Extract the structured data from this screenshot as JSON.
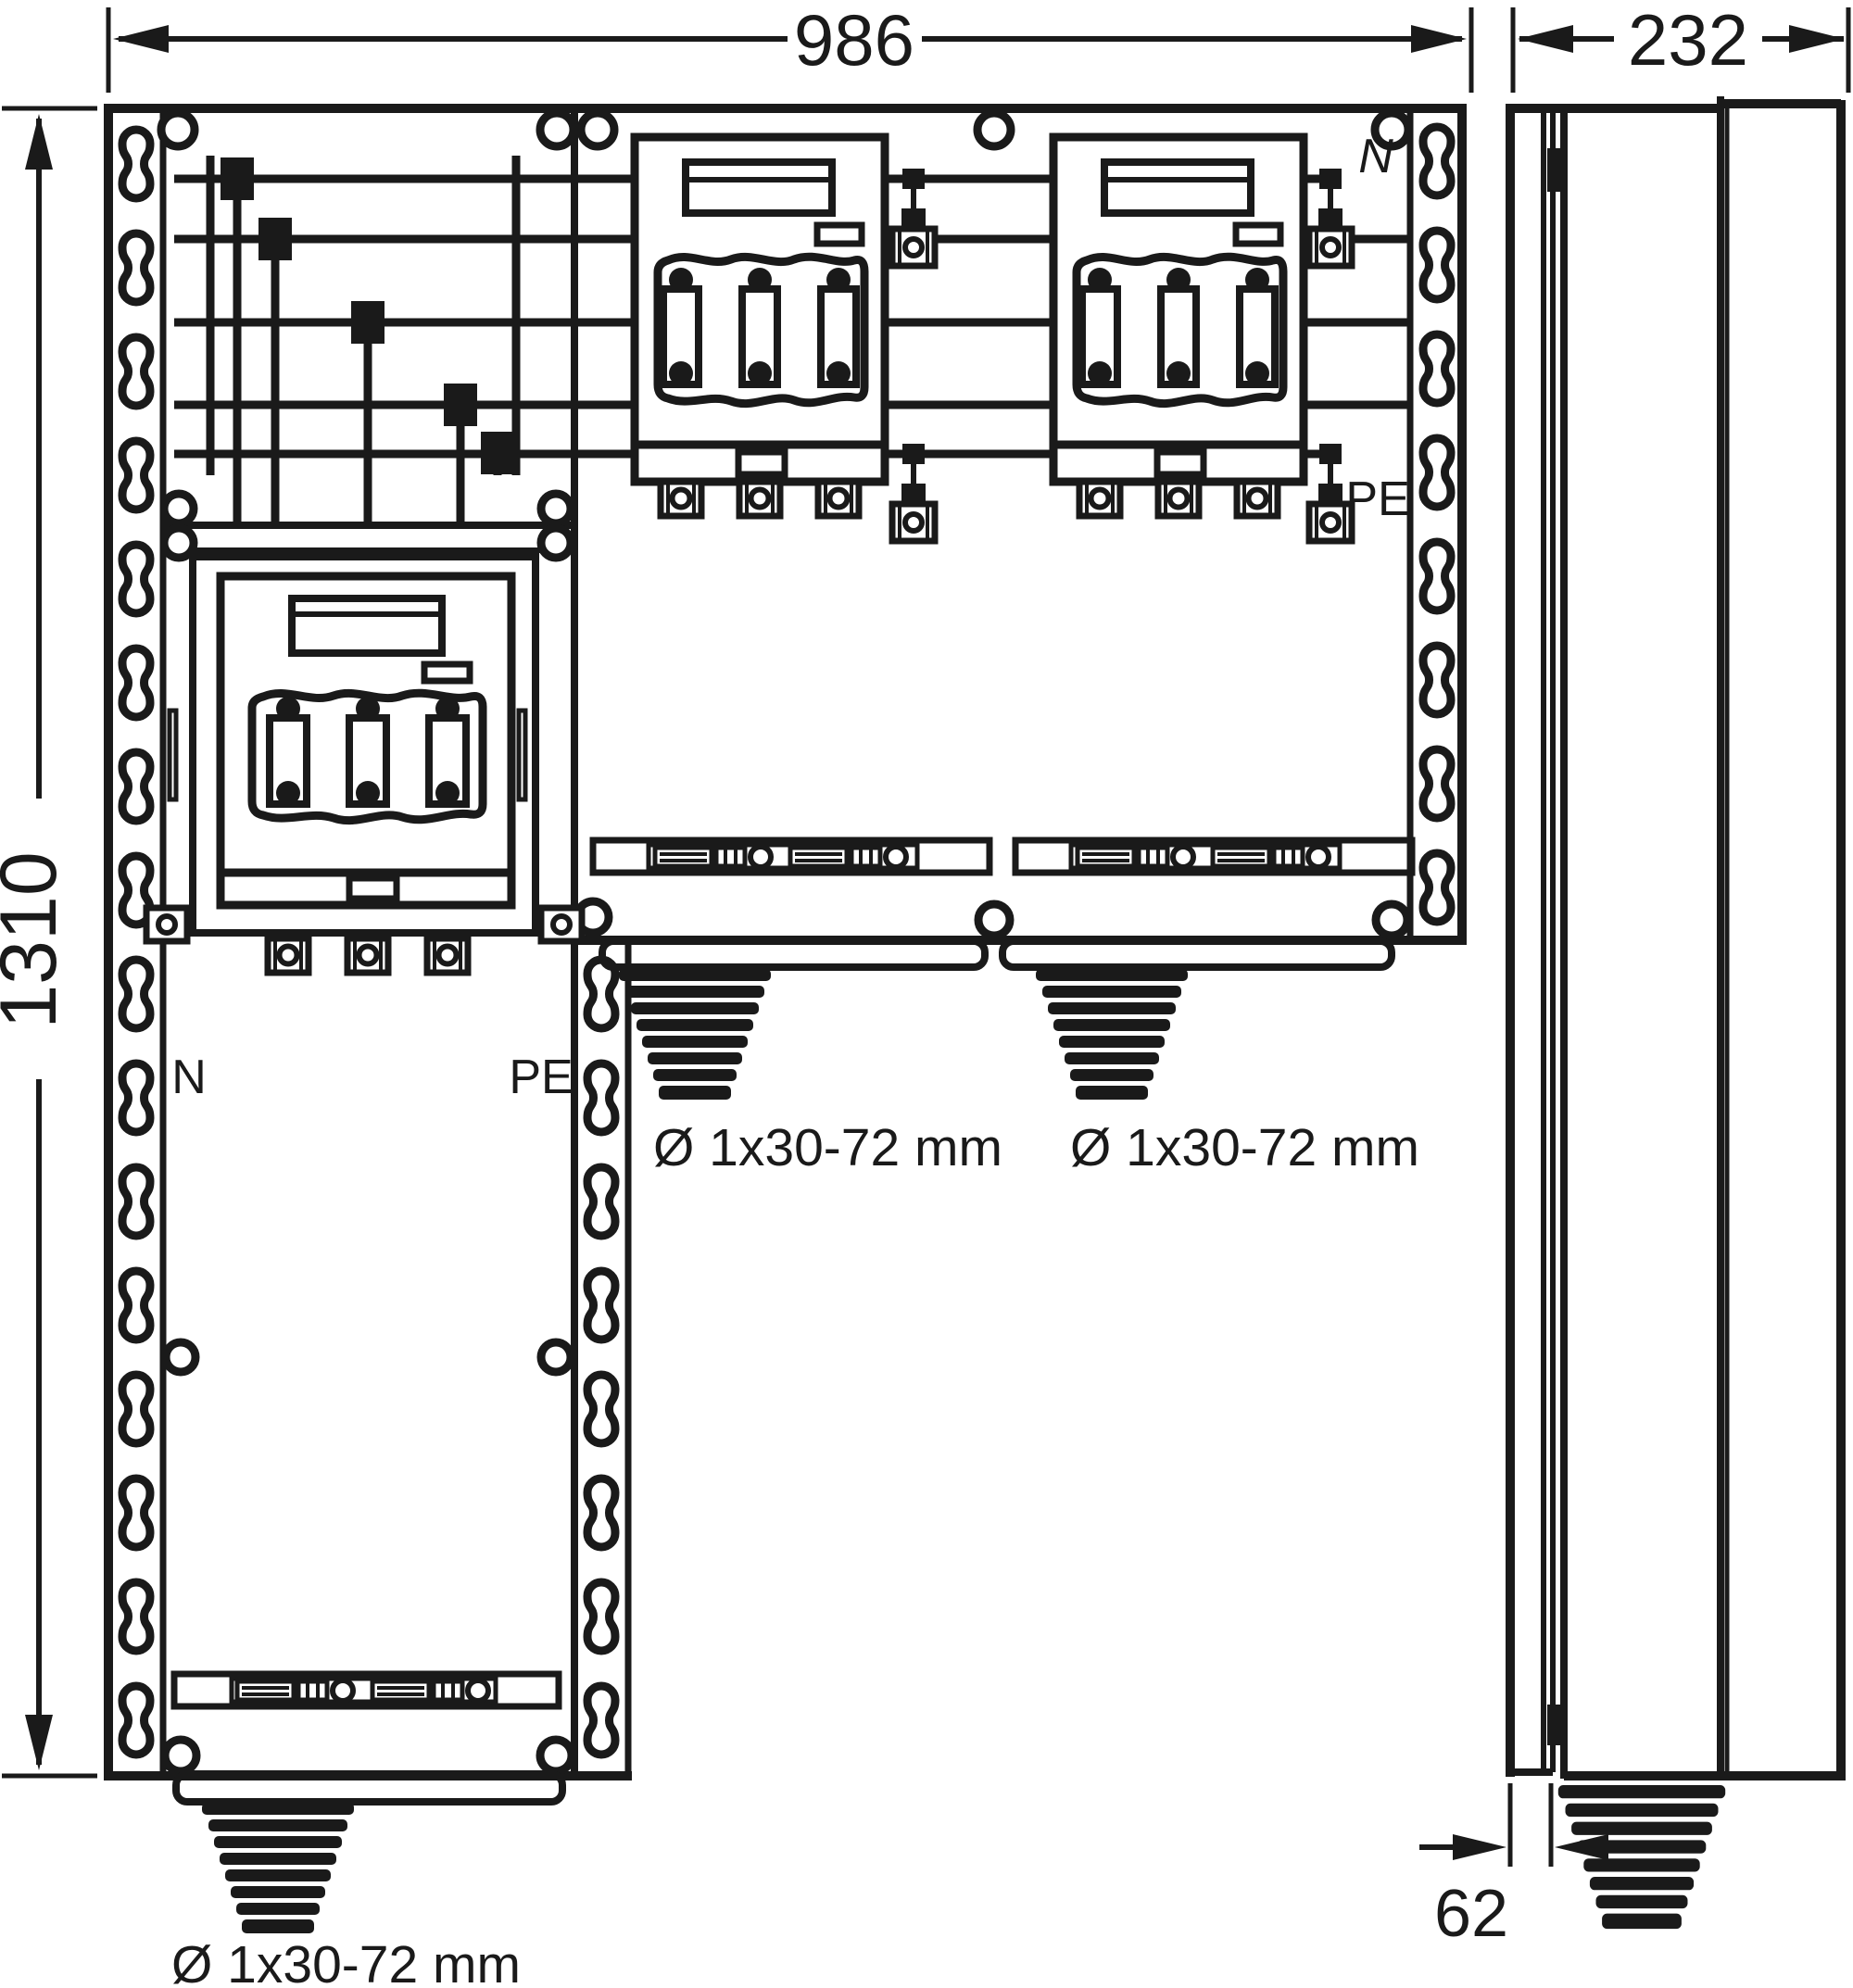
{
  "colors": {
    "ink": "#1a1a1a",
    "paper": "#ffffff"
  },
  "dimensions": {
    "width": "986",
    "depth": "232",
    "height": "1310",
    "bottom_offset": "62"
  },
  "labels": {
    "neutral_bus": "N",
    "pe_bus": "PE",
    "neutral_switch": "N",
    "pe_switch": "PE"
  },
  "cable_glands": {
    "wide_left": "Ø 1x30-72 mm",
    "wide_right": "Ø 1x30-72 mm",
    "column_bottom": "Ø 1x30-72 mm"
  }
}
